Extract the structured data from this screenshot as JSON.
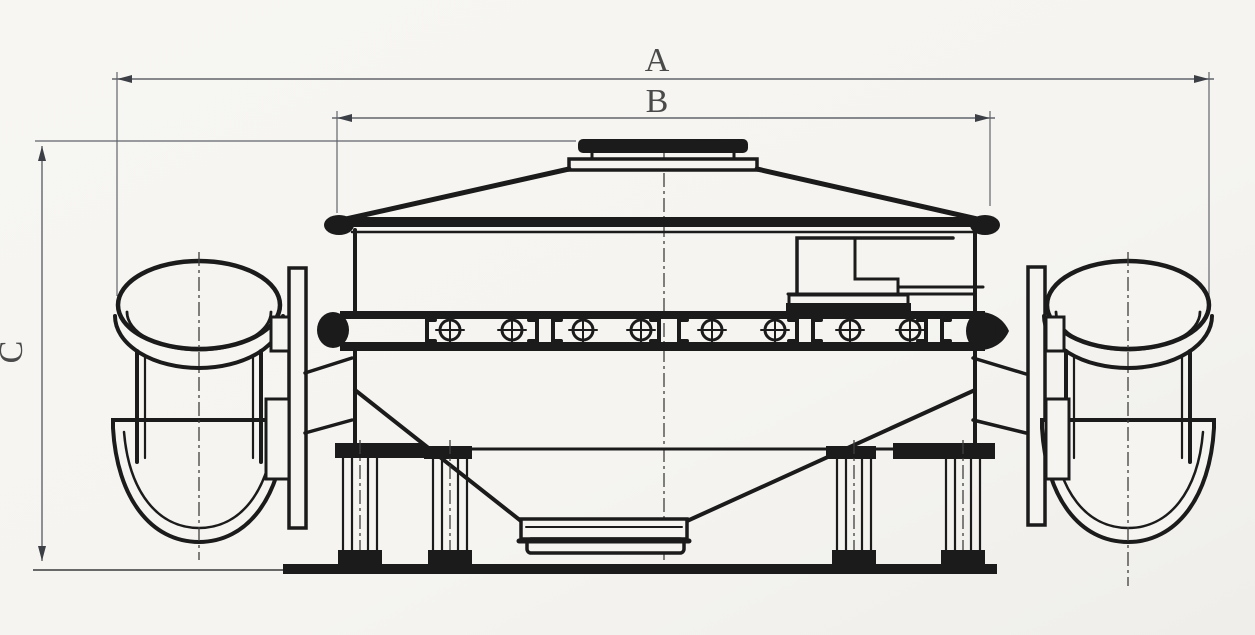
{
  "drawing": {
    "type": "technical-dimension-drawing",
    "labels": {
      "dim_a": "A",
      "dim_b": "B",
      "dim_c": "C"
    },
    "dimensions": [
      {
        "label": "A",
        "orientation": "horizontal",
        "position": "top-outer"
      },
      {
        "label": "B",
        "orientation": "horizontal",
        "position": "top-inner"
      },
      {
        "label": "C",
        "orientation": "vertical",
        "position": "left"
      }
    ],
    "colors": {
      "paper": "#f5f4f0",
      "line": "#1b1b1b",
      "dimension_line": "#60646b",
      "label_text": "#4a4a4a"
    }
  }
}
